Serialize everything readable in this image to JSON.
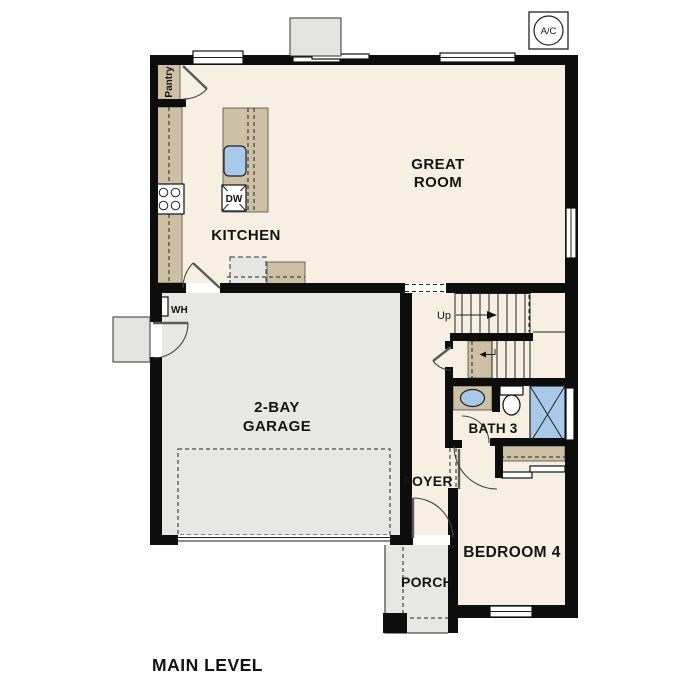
{
  "colors": {
    "floor": "#f7f0e2",
    "cabinet": "#cec0a5",
    "garage": "#e7e7e5",
    "exterior": "#e3e3e1",
    "fixture": "#a9c9e9",
    "wall": "#0d0d0d"
  },
  "plan": {
    "title": "MAIN LEVEL",
    "rooms": {
      "great_room_line1": "GREAT",
      "great_room_line2": "ROOM",
      "kitchen": "KITCHEN",
      "garage_line1": "2-BAY",
      "garage_line2": "GARAGE",
      "bath": "BATH 3",
      "bedroom": "BEDROOM 4",
      "foyer": "FOYER",
      "porch": "PORCH"
    },
    "labels": {
      "ac": "A/C",
      "pantry": "Pantry",
      "dishwasher": "DW",
      "water_heater": "WH",
      "stairs_up": "Up"
    }
  }
}
